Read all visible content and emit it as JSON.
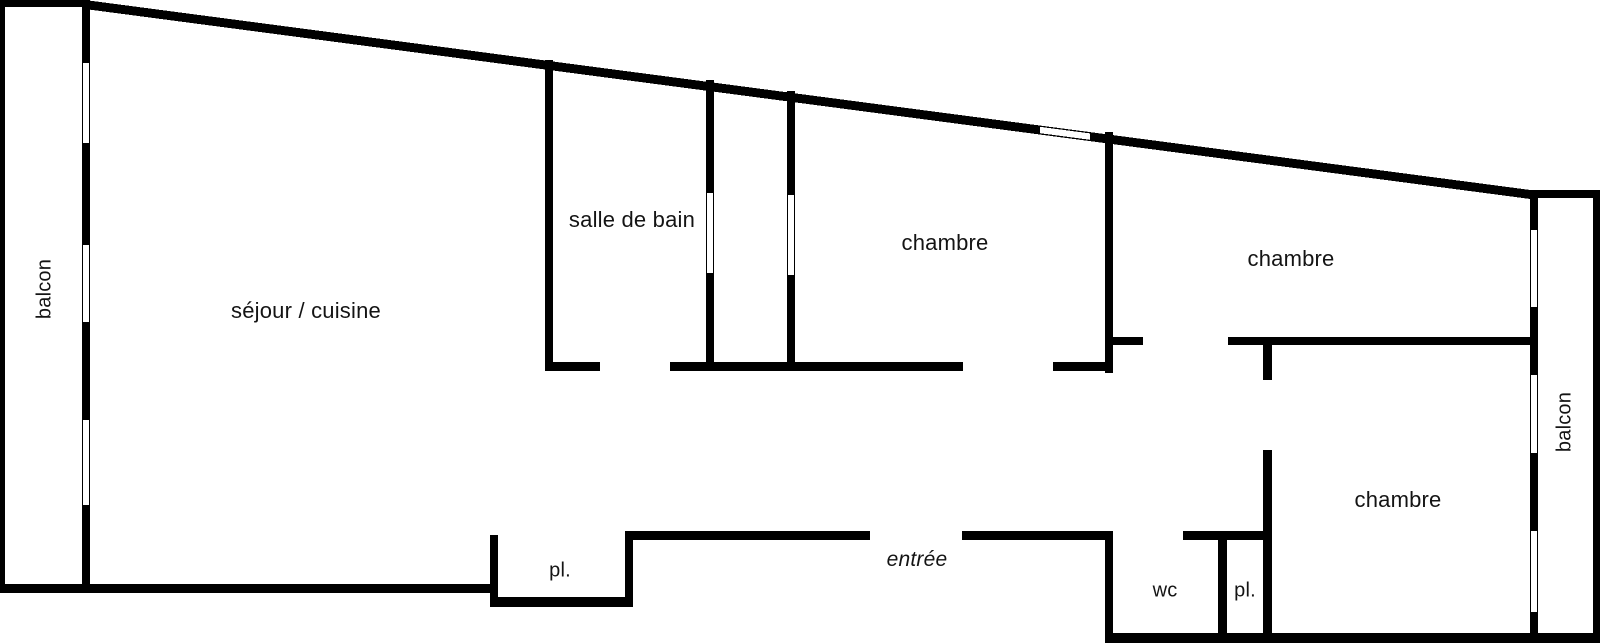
{
  "title": "apartment floor plan",
  "colors": {
    "wall": "#000000",
    "window": "#ffffff",
    "background": "#ffffff",
    "text": "#141414"
  },
  "labels": [
    {
      "id": "balcon-left",
      "text": "balcon",
      "x": 45,
      "y": 289,
      "rotate": true,
      "italic": false,
      "size": 20
    },
    {
      "id": "sejour-cuisine",
      "text": "séjour / cuisine",
      "x": 306,
      "y": 311,
      "rotate": false,
      "italic": false,
      "size": 22
    },
    {
      "id": "salle-de-bain",
      "text": "salle de bain",
      "x": 632,
      "y": 220,
      "rotate": false,
      "italic": false,
      "size": 22
    },
    {
      "id": "chambre-1",
      "text": "chambre",
      "x": 945,
      "y": 243,
      "rotate": false,
      "italic": false,
      "size": 22
    },
    {
      "id": "chambre-2",
      "text": "chambre",
      "x": 1291,
      "y": 259,
      "rotate": false,
      "italic": false,
      "size": 22
    },
    {
      "id": "chambre-3",
      "text": "chambre",
      "x": 1398,
      "y": 500,
      "rotate": false,
      "italic": false,
      "size": 22
    },
    {
      "id": "entree",
      "text": "entrée",
      "x": 917,
      "y": 560,
      "rotate": false,
      "italic": true,
      "size": 21
    },
    {
      "id": "wc",
      "text": "wc",
      "x": 1165,
      "y": 591,
      "rotate": false,
      "italic": false,
      "size": 20
    },
    {
      "id": "pl-1",
      "text": "pl.",
      "x": 560,
      "y": 571,
      "rotate": false,
      "italic": false,
      "size": 20
    },
    {
      "id": "pl-2",
      "text": "pl.",
      "x": 1245,
      "y": 591,
      "rotate": false,
      "italic": false,
      "size": 20
    },
    {
      "id": "balcon-right",
      "text": "balcon",
      "x": 1565,
      "y": 422,
      "rotate": true,
      "italic": false,
      "size": 20
    }
  ],
  "floorplan": {
    "width": 1600,
    "height": 643,
    "sloped_wall": {
      "name": "top-exterior-sloped",
      "points": [
        [
          85,
          0
        ],
        [
          1538,
          191
        ],
        [
          1538,
          200
        ],
        [
          85,
          9
        ]
      ]
    },
    "walls": [
      {
        "name": "balcony-left-top",
        "x": 0,
        "y": 0,
        "w": 88,
        "h": 7
      },
      {
        "name": "balcony-left-outer",
        "x": 0,
        "y": 0,
        "w": 5,
        "h": 592
      },
      {
        "name": "exterior-left-window-wall",
        "x": 82,
        "y": 0,
        "w": 8,
        "h": 588
      },
      {
        "name": "bottom-exterior-left",
        "x": 0,
        "y": 584,
        "w": 490,
        "h": 9
      },
      {
        "name": "balcony-right-top",
        "x": 1530,
        "y": 190,
        "w": 70,
        "h": 8
      },
      {
        "name": "exterior-right-window-wall",
        "x": 1530,
        "y": 191,
        "w": 8,
        "h": 450
      },
      {
        "name": "balcony-right-outer",
        "x": 1593,
        "y": 190,
        "w": 7,
        "h": 453
      },
      {
        "name": "bottom-exterior-right",
        "x": 1105,
        "y": 633,
        "w": 495,
        "h": 10
      },
      {
        "name": "bathroom-left",
        "x": 545,
        "y": 60,
        "w": 8,
        "h": 302
      },
      {
        "name": "hall-top-wall-a1",
        "x": 545,
        "y": 362,
        "w": 55,
        "h": 9
      },
      {
        "name": "hall-top-wall-a2",
        "x": 670,
        "y": 362,
        "w": 293,
        "h": 9
      },
      {
        "name": "hall-top-wall-a3",
        "x": 1053,
        "y": 362,
        "w": 60,
        "h": 9
      },
      {
        "name": "shaft-left",
        "x": 706,
        "y": 80,
        "w": 8,
        "h": 291
      },
      {
        "name": "shaft-right",
        "x": 787,
        "y": 91,
        "w": 8,
        "h": 280
      },
      {
        "name": "bedroom1-right",
        "x": 1105,
        "y": 132,
        "w": 8,
        "h": 241
      },
      {
        "name": "bedroom2-left-stub",
        "x": 1113,
        "y": 337,
        "w": 30,
        "h": 8
      },
      {
        "name": "bedroom2-bottom",
        "x": 1228,
        "y": 337,
        "w": 310,
        "h": 8
      },
      {
        "name": "bedroom3-left-stub",
        "x": 1263,
        "y": 345,
        "w": 9,
        "h": 35
      },
      {
        "name": "bedroom3-left-lower",
        "x": 1263,
        "y": 450,
        "w": 9,
        "h": 188
      },
      {
        "name": "wc-pl-top",
        "x": 1183,
        "y": 531,
        "w": 89,
        "h": 9
      },
      {
        "name": "entry-bottom-left",
        "x": 633,
        "y": 531,
        "w": 237,
        "h": 9
      },
      {
        "name": "entry-bottom-right",
        "x": 962,
        "y": 531,
        "w": 143,
        "h": 9
      },
      {
        "name": "wc-left",
        "x": 1105,
        "y": 531,
        "w": 8,
        "h": 112
      },
      {
        "name": "wc-pl-divider",
        "x": 1218,
        "y": 540,
        "w": 9,
        "h": 103
      },
      {
        "name": "closet1-left",
        "x": 490,
        "y": 535,
        "w": 8,
        "h": 72
      },
      {
        "name": "closet1-right",
        "x": 625,
        "y": 531,
        "w": 8,
        "h": 76
      },
      {
        "name": "closet1-bottom",
        "x": 490,
        "y": 597,
        "w": 143,
        "h": 10
      }
    ],
    "windows": [
      {
        "name": "balcony-left-window-1",
        "x": 83.2,
        "y": 63,
        "w": 5.6,
        "h": 80
      },
      {
        "name": "balcony-left-window-2",
        "x": 83.2,
        "y": 245,
        "w": 5.6,
        "h": 77
      },
      {
        "name": "balcony-left-window-3",
        "x": 83.2,
        "y": 420,
        "w": 5.6,
        "h": 85
      },
      {
        "name": "balcony-right-window-1",
        "x": 1531.2,
        "y": 230,
        "w": 5.6,
        "h": 77
      },
      {
        "name": "balcony-right-window-2",
        "x": 1531.2,
        "y": 375,
        "w": 5.6,
        "h": 78
      },
      {
        "name": "balcony-right-window-3",
        "x": 1531.2,
        "y": 531,
        "w": 5.6,
        "h": 81
      },
      {
        "name": "shaft-left-opening",
        "x": 707.2,
        "y": 193,
        "w": 5.6,
        "h": 80
      },
      {
        "name": "shaft-right-opening",
        "x": 788.2,
        "y": 195,
        "w": 5.6,
        "h": 80
      }
    ],
    "sloped_window": {
      "name": "bedroom1-top-window",
      "points": [
        [
          1040,
          126.8
        ],
        [
          1090,
          133.4
        ],
        [
          1090,
          139.8
        ],
        [
          1040,
          133.2
        ]
      ]
    }
  }
}
